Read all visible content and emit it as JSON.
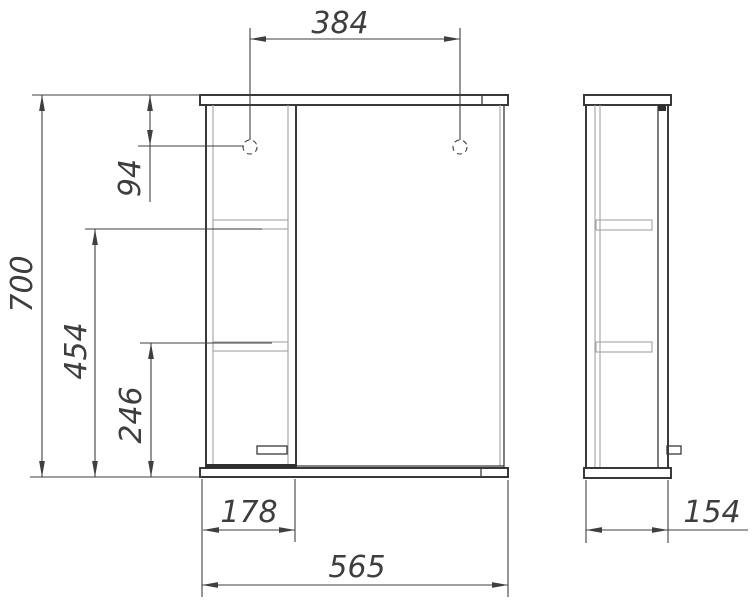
{
  "dims": {
    "hole_spacing": "384",
    "overall_height": "700",
    "hole_offset": "94",
    "upper_shelf_height": "454",
    "lower_shelf_height": "246",
    "column_width": "178",
    "overall_width": "565",
    "depth": "154"
  },
  "colors": {
    "line_dark": "#2f2f2f",
    "line_gray": "#a3a3a3",
    "dimension": "#3f3f3f",
    "background": "#ffffff"
  }
}
